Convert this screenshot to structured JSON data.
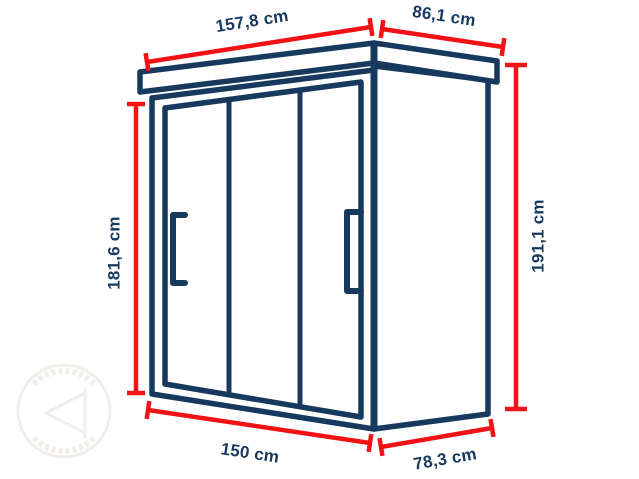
{
  "diagram": {
    "type": "perspective-dimension-drawing",
    "subject": "shed cabinet with flat overhanging roof, three front sliding door panels and two bracket handles",
    "unit": "cm",
    "colors": {
      "outline": "#17395E",
      "dimension_line": "#F01215",
      "label_text": "#17395E",
      "background": "#FFFFFF"
    },
    "dimensions": {
      "roof_front_width": {
        "label": "157,8 cm",
        "value": 157.8,
        "unit": "cm"
      },
      "roof_side_depth": {
        "label": "86,1 cm",
        "value": 86.1,
        "unit": "cm"
      },
      "left_wall_height": {
        "label": "181,6 cm",
        "value": 181.6,
        "unit": "cm"
      },
      "overall_height": {
        "label": "191,1 cm",
        "value": 191.1,
        "unit": "cm"
      },
      "base_front_width": {
        "label": "150 cm",
        "value": 150,
        "unit": "cm"
      },
      "base_side_depth": {
        "label": "78,3 cm",
        "value": 78.3,
        "unit": "cm"
      }
    },
    "watermark": {
      "icon": "circular-stamp-watermark"
    }
  }
}
